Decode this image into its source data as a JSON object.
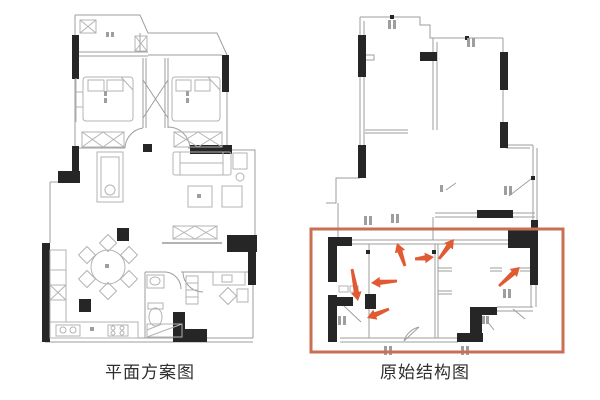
{
  "captions": {
    "left": "平面方案图",
    "right": "原始结构图"
  },
  "colors": {
    "wall_black": "#262626",
    "line_gray": "#9e9e9e",
    "furniture_gray": "#b3b3b3",
    "label_color": "#2f2f2f",
    "annotation_box": "#c96f52",
    "annotation_arrow": "#e05a33",
    "background": "#ffffff"
  },
  "annotation": {
    "box": {
      "x": 311,
      "y": 229,
      "width": 252,
      "height": 123,
      "stroke_width": 3
    },
    "arrows": [
      {
        "x1": 405,
        "y1": 266,
        "x2": 397,
        "y2": 243
      },
      {
        "x1": 415,
        "y1": 259,
        "x2": 434,
        "y2": 257
      },
      {
        "x1": 439,
        "y1": 259,
        "x2": 454,
        "y2": 239
      },
      {
        "x1": 352,
        "y1": 269,
        "x2": 358,
        "y2": 301
      },
      {
        "x1": 397,
        "y1": 281,
        "x2": 371,
        "y2": 283
      },
      {
        "x1": 389,
        "y1": 309,
        "x2": 367,
        "y2": 318
      },
      {
        "x1": 499,
        "y1": 286,
        "x2": 520,
        "y2": 267
      }
    ]
  }
}
